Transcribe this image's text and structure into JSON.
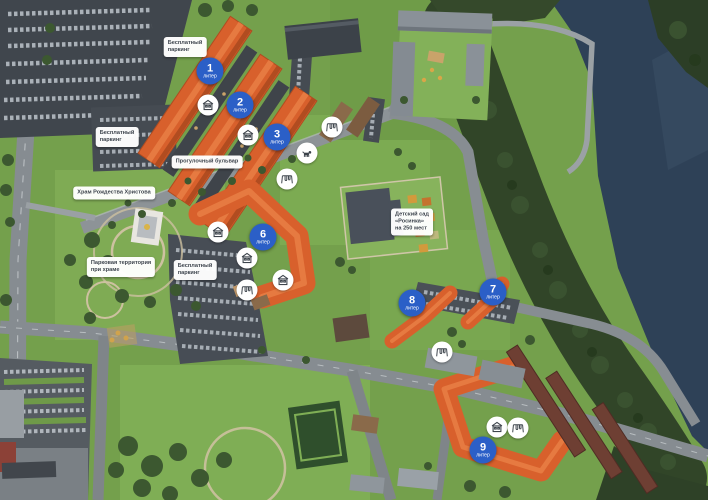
{
  "map": {
    "building_markers": [
      {
        "number": "1",
        "label": "литер",
        "x": 210,
        "y": 71
      },
      {
        "number": "2",
        "label": "литер",
        "x": 240,
        "y": 105
      },
      {
        "number": "3",
        "label": "литер",
        "x": 277,
        "y": 137
      },
      {
        "number": "6",
        "label": "литер",
        "x": 263,
        "y": 237
      },
      {
        "number": "7",
        "label": "литер",
        "x": 493,
        "y": 292
      },
      {
        "number": "8",
        "label": "литер",
        "x": 412,
        "y": 303
      },
      {
        "number": "9",
        "label": "литер",
        "x": 483,
        "y": 450
      }
    ],
    "area_labels": [
      {
        "id": "free-parking-north",
        "lines": [
          "Бесплатный",
          "паркинг"
        ],
        "x": 185,
        "y": 47
      },
      {
        "id": "free-parking-west",
        "lines": [
          "Бесплатный",
          "паркинг"
        ],
        "x": 117,
        "y": 137
      },
      {
        "id": "boulevard",
        "lines": [
          "Прогулочный бульвар"
        ],
        "x": 207,
        "y": 162
      },
      {
        "id": "church",
        "lines": [
          "Храм Рождества Христова"
        ],
        "x": 114,
        "y": 193
      },
      {
        "id": "park-territory",
        "lines": [
          "Парковая территория",
          "при храме"
        ],
        "x": 121,
        "y": 267
      },
      {
        "id": "free-parking-center",
        "lines": [
          "Бесплатный",
          "паркинг"
        ],
        "x": 195,
        "y": 270
      },
      {
        "id": "kindergarten",
        "lines": [
          "Детский сад",
          "«Росинка»",
          "на 250 мест"
        ],
        "x": 412,
        "y": 222
      }
    ],
    "amenity_markers": [
      {
        "icon": "storefront-icon",
        "x": 208,
        "y": 105
      },
      {
        "icon": "storefront-icon",
        "x": 248,
        "y": 135
      },
      {
        "icon": "playground-icon",
        "x": 332,
        "y": 127
      },
      {
        "icon": "dog-walking-icon",
        "x": 307,
        "y": 153
      },
      {
        "icon": "playground-icon",
        "x": 287,
        "y": 179
      },
      {
        "icon": "storefront-icon",
        "x": 218,
        "y": 232
      },
      {
        "icon": "storefront-icon",
        "x": 247,
        "y": 258
      },
      {
        "icon": "storefront-icon",
        "x": 283,
        "y": 280
      },
      {
        "icon": "playground-icon",
        "x": 247,
        "y": 290
      },
      {
        "icon": "playground-icon",
        "x": 442,
        "y": 352
      },
      {
        "icon": "storefront-icon",
        "x": 497,
        "y": 427
      },
      {
        "icon": "playground-icon",
        "x": 518,
        "y": 428
      }
    ],
    "colors": {
      "marker_blue": "#2b5fc7",
      "roof_orange": "#d8602c",
      "lake": "#2e4157",
      "forest": "#314528",
      "lawn": "#74a04c",
      "road": "#868c91",
      "label_text": "#3e454e"
    }
  }
}
